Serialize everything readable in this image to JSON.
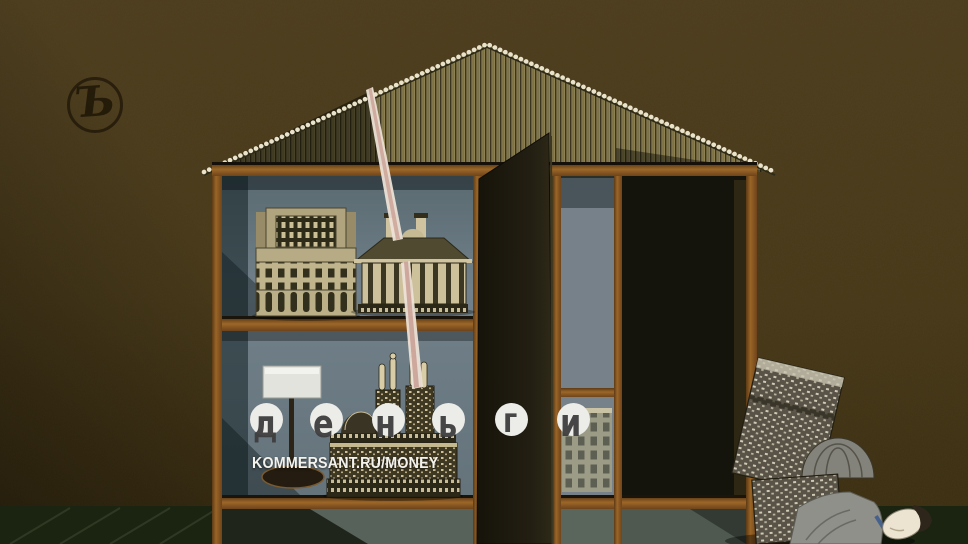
{
  "brand": {
    "publisher_mark": "Ъ",
    "magazine_title": "деньги",
    "magazine_letters": [
      "д",
      "е",
      "н",
      "ь",
      "г",
      "и"
    ],
    "site_url": "KOMMERSANT.RU/MONEY"
  },
  "artwork": {
    "alt": "Surreal collage: a house-shaped cabinet with shelves of miniature classical buildings, its dark door open; a thin beam of light falls from the roof onto a model cathedral; outside, stacked building models lean over a figure lying on the floor.",
    "colors": {
      "background": "#48391b",
      "floor": "#232e17",
      "roof": "#8d8152",
      "frame_rust": "#8a5a28",
      "shelf_interior": "#6e7c83",
      "door": "#1e1a10",
      "light_beam": "#e9dfd4",
      "circle_fill": "#ecece9",
      "letter_color": "#3e3e3e",
      "url_text": "#f3f2ed"
    }
  }
}
